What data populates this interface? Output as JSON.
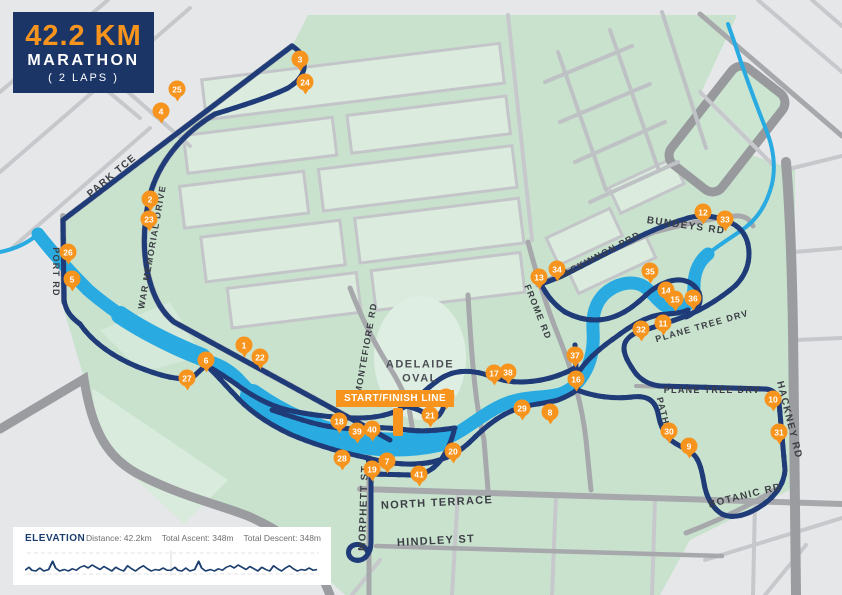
{
  "badge": {
    "distance": "42.2 KM",
    "title": "MARATHON",
    "laps": "( 2 LAPS )"
  },
  "map": {
    "start_finish_label": "START/FINISH LINE",
    "oval_label_line1": "ADELAIDE",
    "oval_label_line2": "OVAL",
    "street_labels": [
      {
        "text": "PARK TCE",
        "x": 112,
        "y": 176,
        "rot": -40,
        "size": 10
      },
      {
        "text": "WAR MEMORIAL DRIVE",
        "x": 152,
        "y": 247,
        "rot": -80,
        "size": 9
      },
      {
        "text": "PORT RD",
        "x": 56,
        "y": 272,
        "rot": 90,
        "size": 9
      },
      {
        "text": "MONTEFIORE RD",
        "x": 366,
        "y": 348,
        "rot": -80,
        "size": 9
      },
      {
        "text": "FROME RD",
        "x": 538,
        "y": 312,
        "rot": 68,
        "size": 9
      },
      {
        "text": "MACKINNON PRD",
        "x": 598,
        "y": 256,
        "rot": -28,
        "size": 9
      },
      {
        "text": "BUNDEYS RD",
        "x": 686,
        "y": 226,
        "rot": 8,
        "size": 10
      },
      {
        "text": "PLANE TREE DRV",
        "x": 702,
        "y": 326,
        "rot": -16,
        "size": 9
      },
      {
        "text": "PLANE TREE DRV",
        "x": 712,
        "y": 390,
        "rot": 0,
        "size": 9
      },
      {
        "text": "PATH",
        "x": 663,
        "y": 411,
        "rot": 76,
        "size": 9
      },
      {
        "text": "HACKNEY RD",
        "x": 789,
        "y": 420,
        "rot": 76,
        "size": 10
      },
      {
        "text": "BOTANIC RD",
        "x": 745,
        "y": 496,
        "rot": -14,
        "size": 10
      },
      {
        "text": "NORTH TERRACE",
        "x": 437,
        "y": 503,
        "rot": -3,
        "size": 11
      },
      {
        "text": "MORPHETT ST",
        "x": 364,
        "y": 508,
        "rot": -88,
        "size": 10
      },
      {
        "text": "HINDLEY ST",
        "x": 436,
        "y": 541,
        "rot": -3,
        "size": 11
      }
    ],
    "km_markers": [
      {
        "n": 1,
        "x": 244,
        "y": 345
      },
      {
        "n": 2,
        "x": 150,
        "y": 199
      },
      {
        "n": 3,
        "x": 300,
        "y": 59
      },
      {
        "n": 4,
        "x": 161,
        "y": 111
      },
      {
        "n": 5,
        "x": 72,
        "y": 279
      },
      {
        "n": 6,
        "x": 206,
        "y": 360
      },
      {
        "n": 7,
        "x": 387,
        "y": 461
      },
      {
        "n": 8,
        "x": 550,
        "y": 412
      },
      {
        "n": 9,
        "x": 689,
        "y": 446
      },
      {
        "n": 10,
        "x": 773,
        "y": 399
      },
      {
        "n": 11,
        "x": 663,
        "y": 323
      },
      {
        "n": 12,
        "x": 703,
        "y": 212
      },
      {
        "n": 13,
        "x": 539,
        "y": 277
      },
      {
        "n": 14,
        "x": 666,
        "y": 290
      },
      {
        "n": 15,
        "x": 675,
        "y": 299
      },
      {
        "n": 16,
        "x": 576,
        "y": 379
      },
      {
        "n": 17,
        "x": 494,
        "y": 373
      },
      {
        "n": 18,
        "x": 339,
        "y": 421
      },
      {
        "n": 19,
        "x": 372,
        "y": 469
      },
      {
        "n": 20,
        "x": 453,
        "y": 451
      },
      {
        "n": 21,
        "x": 430,
        "y": 415
      },
      {
        "n": 22,
        "x": 260,
        "y": 357
      },
      {
        "n": 23,
        "x": 149,
        "y": 219
      },
      {
        "n": 24,
        "x": 305,
        "y": 82
      },
      {
        "n": 25,
        "x": 177,
        "y": 89
      },
      {
        "n": 26,
        "x": 68,
        "y": 252
      },
      {
        "n": 27,
        "x": 187,
        "y": 378
      },
      {
        "n": 28,
        "x": 342,
        "y": 458
      },
      {
        "n": 29,
        "x": 522,
        "y": 408
      },
      {
        "n": 30,
        "x": 669,
        "y": 431
      },
      {
        "n": 31,
        "x": 779,
        "y": 432
      },
      {
        "n": 32,
        "x": 641,
        "y": 329
      },
      {
        "n": 33,
        "x": 725,
        "y": 219
      },
      {
        "n": 34,
        "x": 557,
        "y": 269
      },
      {
        "n": 35,
        "x": 650,
        "y": 271
      },
      {
        "n": 36,
        "x": 693,
        "y": 298
      },
      {
        "n": 37,
        "x": 575,
        "y": 355
      },
      {
        "n": 38,
        "x": 508,
        "y": 372
      },
      {
        "n": 39,
        "x": 357,
        "y": 431
      },
      {
        "n": 40,
        "x": 372,
        "y": 429
      },
      {
        "n": 41,
        "x": 419,
        "y": 474
      },
      {
        "n": 42,
        "x": 446,
        "y": 397
      }
    ]
  },
  "elevation": {
    "title": "ELEVATION",
    "distance": "Distance: 42.2km",
    "ascent": "Total Ascent: 348m",
    "descent": "Total Descent: 348m",
    "profile_points": "0,31 4,27 7,31 11,32 15,28 19,32 24,30 28,19 31,28 35,32 40,30 44,32 48,29 52,31 56,27 60,25 64,28 68,24 72,27 76,30 80,26 84,29 88,32 92,27 96,30 100,32 104,25 108,29 112,32 116,28 120,25 124,29 128,32 132,30 136,31 140,28 144,31 148,31 152,27 155,31 159,32 163,28 167,32 172,30 176,19 179,28 183,32 188,30 192,32 196,29 200,31 204,27 208,25 212,28 216,24 220,27 224,30 228,26 232,29 236,32 240,27 244,30 248,32 252,25 256,29 260,32 264,28 268,25 272,29 276,32 280,30 284,31 288,28 292,31 296,30"
  },
  "colors": {
    "route_navy": "#1F3B78",
    "route_dash": "#8CA3CF",
    "river_blue": "#29ABE2",
    "marker_orange": "#F7941E",
    "badge_navy": "#1B3566",
    "parkland_green": "#C9E2CE",
    "background_gray": "#E5E7E9"
  }
}
